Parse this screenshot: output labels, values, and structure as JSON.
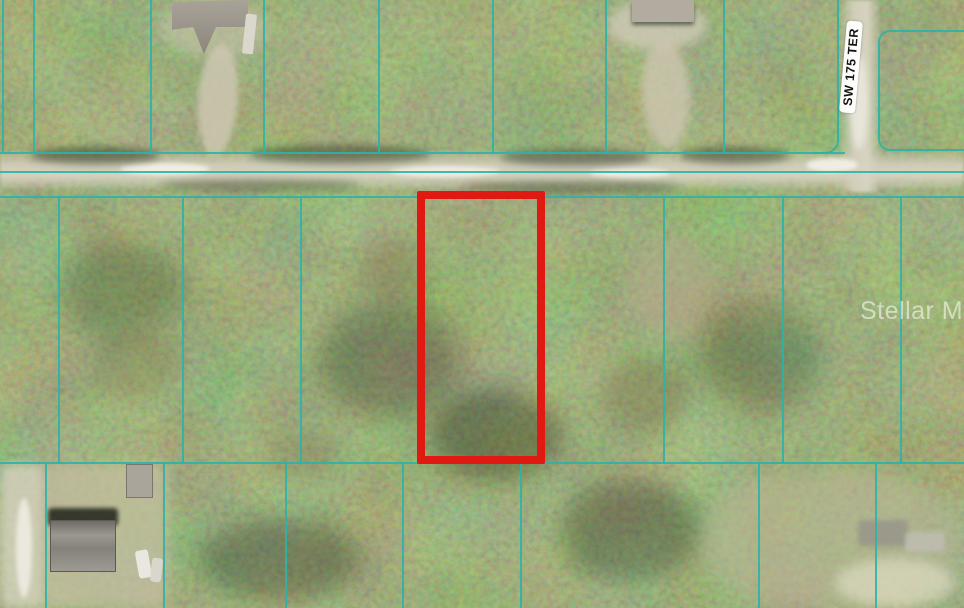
{
  "map": {
    "type": "aerial-parcel-map",
    "street_label": "SW 175 TER",
    "watermark_text": "Stellar MLS",
    "colors": {
      "boundary_line": "#2db3a6",
      "highlight_outline": "#e01912",
      "road_surface": "#cfc9b4",
      "label_background": "#ffffff",
      "label_text": "#141414",
      "forest_base": "#55663e"
    },
    "highlight_parcel_px": {
      "left": 417,
      "top": 191,
      "width": 128,
      "height": 273,
      "stroke": 8
    },
    "roads": {
      "horizontal": {
        "left": 0,
        "top": 151,
        "width": 964,
        "height": 38
      },
      "vertical": {
        "left": 841,
        "top": 0,
        "width": 38,
        "height": 192
      }
    },
    "boundary_lines": {
      "horizontal": [
        {
          "x": 0,
          "y": 152,
          "len": 845
        },
        {
          "x": 0,
          "y": 171,
          "len": 964
        },
        {
          "x": 0,
          "y": 196,
          "len": 964
        },
        {
          "x": 0,
          "y": 462,
          "len": 964
        }
      ],
      "vertical": [
        {
          "x": 2,
          "y": 0,
          "len": 153
        },
        {
          "x": 33,
          "y": 0,
          "len": 153
        },
        {
          "x": 150,
          "y": 0,
          "len": 153
        },
        {
          "x": 263,
          "y": 0,
          "len": 153
        },
        {
          "x": 378,
          "y": 0,
          "len": 153
        },
        {
          "x": 492,
          "y": 0,
          "len": 153
        },
        {
          "x": 605,
          "y": 0,
          "len": 153
        },
        {
          "x": 723,
          "y": 0,
          "len": 153
        },
        {
          "x": 837,
          "y": 0,
          "len": 142
        },
        {
          "x": 58,
          "y": 197,
          "len": 266
        },
        {
          "x": 182,
          "y": 197,
          "len": 266
        },
        {
          "x": 300,
          "y": 197,
          "len": 266
        },
        {
          "x": 663,
          "y": 197,
          "len": 266
        },
        {
          "x": 782,
          "y": 197,
          "len": 266
        },
        {
          "x": 900,
          "y": 197,
          "len": 266
        },
        {
          "x": 45,
          "y": 463,
          "len": 145
        },
        {
          "x": 163,
          "y": 463,
          "len": 145
        },
        {
          "x": 285,
          "y": 463,
          "len": 145
        },
        {
          "x": 402,
          "y": 463,
          "len": 145
        },
        {
          "x": 520,
          "y": 463,
          "len": 145
        },
        {
          "x": 758,
          "y": 463,
          "len": 145
        },
        {
          "x": 875,
          "y": 463,
          "len": 145
        }
      ],
      "east_bracket": {
        "left": 878,
        "top": 30,
        "width": 86,
        "height": 121
      },
      "west_corner": {
        "left": 812,
        "top": 108,
        "width": 27,
        "height": 46
      }
    }
  }
}
